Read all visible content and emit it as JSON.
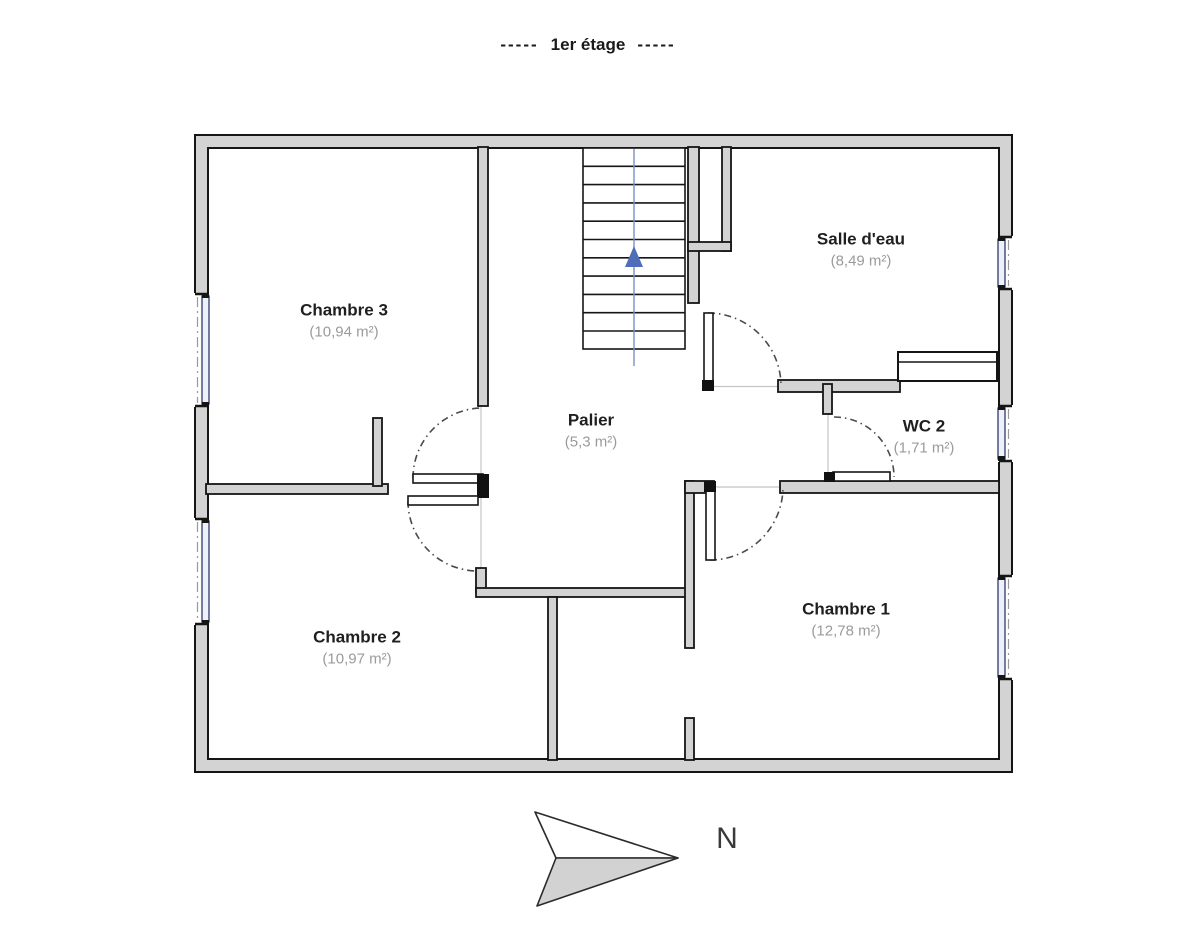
{
  "title": {
    "left_dashes": "-----",
    "text": "1er étage",
    "right_dashes": "-----"
  },
  "rooms": [
    {
      "id": "chambre-3",
      "name": "Chambre 3",
      "area": "(10,94 m²)"
    },
    {
      "id": "salle-d-eau",
      "name": "Salle d'eau",
      "area": "(8,49 m²)"
    },
    {
      "id": "palier",
      "name": "Palier",
      "area": "(5,3 m²)"
    },
    {
      "id": "wc-2",
      "name": "WC 2",
      "area": "(1,71 m²)"
    },
    {
      "id": "chambre-2",
      "name": "Chambre 2",
      "area": "(10,97 m²)"
    },
    {
      "id": "chambre-1",
      "name": "Chambre 1",
      "area": "(12,78 m²)"
    }
  ],
  "compass": {
    "label": "N"
  },
  "colors": {
    "wall_fill": "#d3d3d3",
    "wall_stroke": "#151515",
    "window_frame": "#2e3a6e",
    "window_fill": "#eef1f8",
    "stair_line": "#7d8fc5",
    "stair_arrow": "#4f6db8",
    "area_text": "#9b9b9b",
    "compass_fill": "#d2d2d2"
  }
}
